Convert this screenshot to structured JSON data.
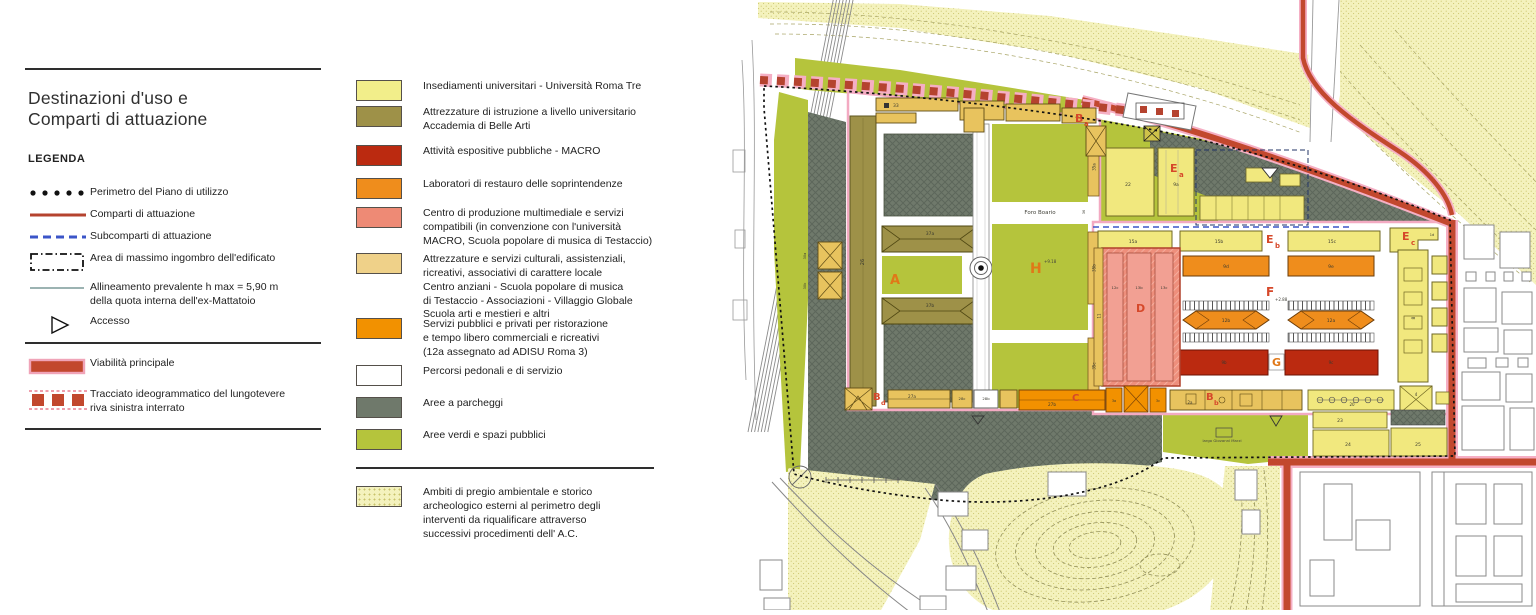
{
  "legend": {
    "title_line1": "Destinazioni d'uso e",
    "title_line2": "Comparti di attuazione",
    "legend_heading": "LEGENDA",
    "line_items": [
      {
        "symbol": "dotted-black-line",
        "label": "Perimetro del Piano di utilizzo"
      },
      {
        "symbol": "solid-red-line",
        "label": "Comparti di attuazione"
      },
      {
        "symbol": "dashed-blue-line",
        "label": "Subcomparti di attuazione"
      },
      {
        "symbol": "dashdot-black-rect",
        "label": "Area di massimo ingombro dell'edificato"
      },
      {
        "symbol": "thin-gray-line",
        "label": "Allineamento prevalente   h max = 5,90 m\ndella quota interna dell'ex-Mattatoio"
      },
      {
        "symbol": "triangle-outline",
        "label": "Accesso"
      }
    ],
    "road_items": [
      {
        "symbol": "red-bar",
        "label": "Viabilità principale"
      },
      {
        "symbol": "red-dashed-squares",
        "label": "Tracciato ideogrammatico del lungotevere\nriva sinistra interrato"
      }
    ],
    "area_items": [
      {
        "color": "#f2ee8a",
        "label": "Insediamenti universitari - Università Roma Tre"
      },
      {
        "color": "#9e9148",
        "label": "Attrezzature di istruzione a livello universitario\nAccademia di Belle Arti"
      },
      {
        "color": "#bb2a10",
        "label": "Attività espositive pubbliche - MACRO"
      },
      {
        "color": "#ef8d1c",
        "label": "Laboratori di restauro delle soprintendenze"
      },
      {
        "color": "#ee8a75",
        "label": "Centro di produzione multimediale e servizi\ncompatibili (in convenzione con l'università\nMACRO, Scuola popolare di musica di Testaccio)"
      },
      {
        "color": "#efd189",
        "label": "Attrezzature e servizi culturali, assistenziali,\nricreativi, associativi di carattere locale\nCentro anziani - Scuola popolare di musica\ndi Testaccio - Associazioni - Villaggio Globale\nScuola arti e mestieri e altri"
      },
      {
        "color": "#f29100",
        "label": "Servizi  pubblici e privati per ristorazione\ne tempo libero commerciali e ricreativi\n(12a assegnato ad ADISU Roma 3)"
      },
      {
        "color": "#ffffff",
        "label": "Percorsi pedonali e di servizio"
      },
      {
        "color": "#6f796b",
        "label": "Aree a parcheggi"
      },
      {
        "color": "#b5c43c",
        "label": "Aree verdi e spazi pubblici"
      }
    ],
    "ambiti_item": {
      "label": "Ambiti di pregio ambientale e storico\narcheologico esterni al perimetro degli\ninterventi da riqualificare attraverso\nsuccessivi procedimenti dell' A.C."
    }
  },
  "colors": {
    "road_red": "#c2482e",
    "comparti_red": "#b5432f",
    "subcomparti_blue": "#3b55c8",
    "perimeter_black": "#111111",
    "green": "#b5c43c",
    "parking_gray": "#6f796b",
    "univ_yellow": "#f2ee8a",
    "accademia_olive": "#9e9148",
    "macro_dark_red": "#bb2a10",
    "laboratori_orange": "#ef8d1c",
    "multimedia_salmon": "#ee8a75",
    "culturali_tan": "#efd189",
    "servizi_orange": "#f29100",
    "ambiti_cream": "#f4f2bd"
  },
  "map": {
    "labels": {
      "foro_boario": "Foro Boario",
      "largo": "largo Giovanni Marzi",
      "A": "A",
      "B": "B",
      "C": "C",
      "D": "D",
      "E": "E",
      "F": "F",
      "G": "G",
      "H": "H",
      "sub_a": "a",
      "sub_b": "b",
      "sub_c": "c",
      "sub_d": "d",
      "elev_918": "+9.18",
      "elev_288": "+2.88",
      "n26": "26",
      "n30a": "30a",
      "n30b": "30b",
      "n33": "33",
      "n37a": "37a",
      "n37b": "37b",
      "n35a": "35a",
      "n35b": "35b",
      "n35c": "35c",
      "n36": "36",
      "n22": "22",
      "n9a": "9a",
      "n15a": "15a",
      "n15b": "15b",
      "n15c": "15c",
      "n9d": "9d",
      "n9e": "9e",
      "n12a": "12a",
      "n12b": "12b",
      "n9b": "9b",
      "n9c": "9c",
      "n12c": "12c",
      "n13b": "13b",
      "n13c": "13c",
      "n11": "11",
      "n8": "8",
      "n1d": "1d",
      "n20": "20",
      "n4": "4",
      "n23": "23",
      "n24": "24",
      "n25": "25",
      "n27a": "27a",
      "n27b": "27b",
      "n28b": "28b",
      "n28c": "28c",
      "n2a": "2a",
      "n3a": "3a",
      "n3c": "3c"
    }
  }
}
